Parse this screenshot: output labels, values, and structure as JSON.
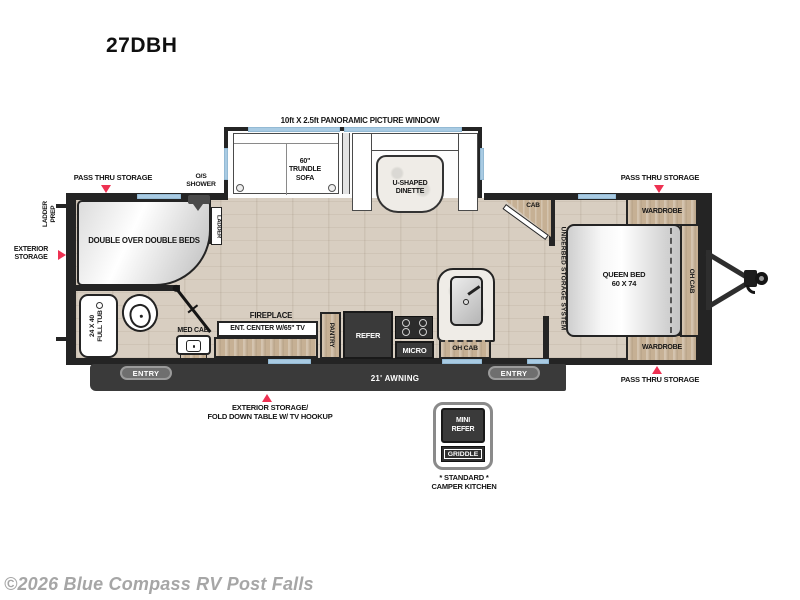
{
  "page": {
    "title": "27DBH",
    "watermark": "©2026 Blue Compass RV Post Falls"
  },
  "colors": {
    "accent_red": "#ee3152",
    "window_blue": "#a9cbe3",
    "cabinet_tan": "#c6b094",
    "wall_dark": "#242424",
    "appliance_dark": "#3a3a3a",
    "floor_wood": "#d8cec1",
    "watermark_gray": "#a6a6a6"
  },
  "slideout": {
    "window_label": "10ft X 2.5ft PANORAMIC PICTURE WINDOW",
    "sofa_line1": "60\"",
    "sofa_line2": "TRUNDLE",
    "sofa_line3": "SOFA",
    "dinette_line1": "U-SHAPED",
    "dinette_line2": "DINETTE"
  },
  "left_section": {
    "pass_thru": "PASS THRU STORAGE",
    "os_shower_line1": "O/S",
    "os_shower_line2": "SHOWER",
    "ladder_prep_line1": "LADDER",
    "ladder_prep_line2": "PREP",
    "exterior_line1": "EXTERIOR",
    "exterior_line2": "STORAGE",
    "bunks": "DOUBLE OVER DOUBLE BEDS",
    "ladder": "LADDER",
    "tub_line1": "24 X 40",
    "tub_line2": "FULL TUB",
    "med_cab": "MED CAB",
    "entry": "ENTRY"
  },
  "center_section": {
    "fireplace": "FIREPLACE",
    "ent_center": "ENT. CENTER W/65\" TV",
    "pantry": "PANTRY",
    "refer": "REFER",
    "micro": "MICRO",
    "oh_cab": "OH CAB",
    "cab": "CAB",
    "underbed": "UNDERBED STORAGE SYSTEM",
    "entry": "ENTRY",
    "awning": "21' AWNING"
  },
  "bedroom": {
    "pass_thru_top": "PASS THRU STORAGE",
    "pass_thru_bottom": "PASS THRU STORAGE",
    "wardrobe_top": "WARDROBE",
    "wardrobe_bottom": "WARDROBE",
    "queen_line1": "QUEEN BED",
    "queen_line2": "60 X 74",
    "oh_cab": "OH CAB"
  },
  "exterior_note": {
    "line1": "EXTERIOR STORAGE/",
    "line2": "FOLD DOWN TABLE W/ TV HOOKUP"
  },
  "camper_kitchen": {
    "mini_line1": "MINI",
    "mini_line2": "REFER",
    "griddle": "GRIDDLE",
    "std_line1": "* STANDARD *",
    "std_line2": "CAMPER KITCHEN"
  }
}
